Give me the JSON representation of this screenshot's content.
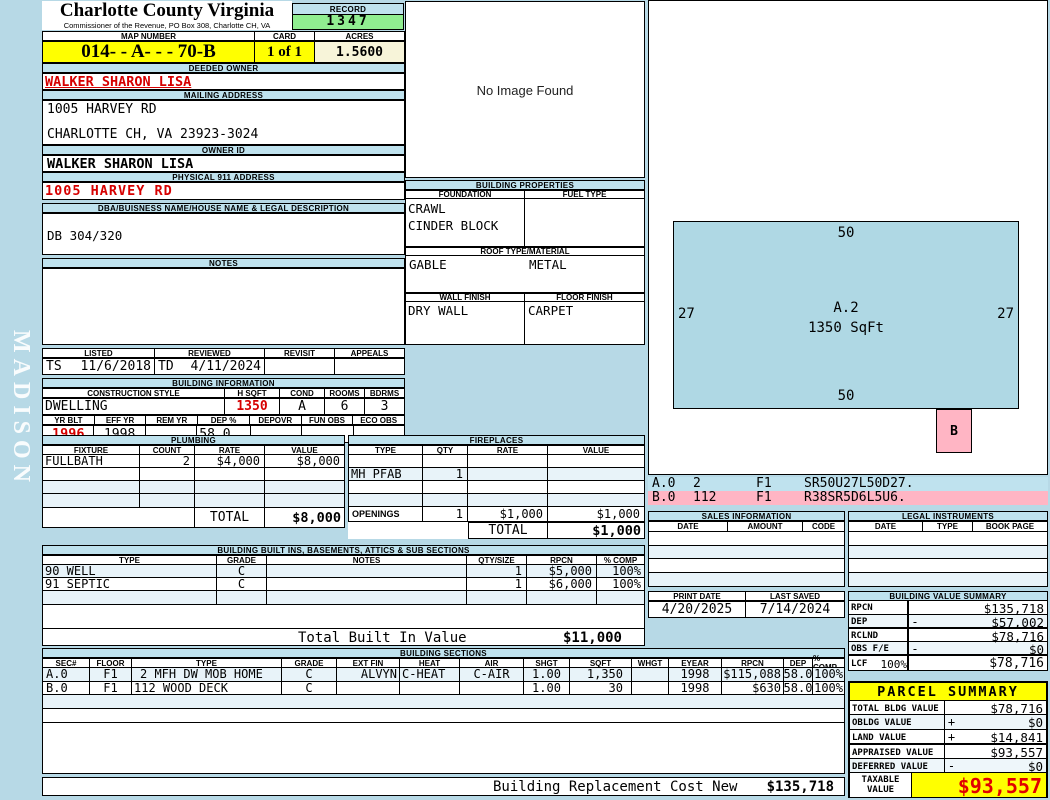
{
  "sidebar": {
    "watermark": "MADISON"
  },
  "colors": {
    "page_bg": "#b7d9e6",
    "header_blue": "#bfe2ee",
    "record_green": "#90ee90",
    "highlight_yellow": "#ffff00",
    "acres_cream": "#f7f4d9",
    "pink": "#ffb5c4",
    "sketch_blue": "#afd8e4",
    "alert_red": "#d60000"
  },
  "header": {
    "county": "Charlotte County Virginia",
    "commissioner": "Commissioner of the Revenue, PO Box 308, Charlotte CH, VA",
    "record_label": "RECORD",
    "record_value": "1347",
    "map_number_label": "MAP NUMBER",
    "map_number": "014- - A-  -  - 70-B",
    "card_label": "CARD",
    "card_value": "1 of 1",
    "acres_label": "ACRES",
    "acres_value": "1.5600"
  },
  "owner": {
    "deeded_owner_label": "DEEDED OWNER",
    "deeded_owner": "WALKER SHARON LISA",
    "mailing_address_label": "MAILING ADDRESS",
    "mailing_line1": "1005 HARVEY RD",
    "mailing_line2": "CHARLOTTE CH, VA 23923-3024",
    "owner_id_label": "OWNER ID",
    "owner_id": "WALKER SHARON LISA",
    "physical_label": "PHYSICAL 911 ADDRESS",
    "physical_address": "1005 HARVEY RD",
    "dba_label": "DBA/BUISNESS NAME/HOUSE NAME & LEGAL DESCRIPTION",
    "dba_value": "DB 304/320",
    "notes_label": "NOTES",
    "notes_value": ""
  },
  "photo": {
    "placeholder": "No Image Found"
  },
  "building_properties": {
    "title": "BUILDING PROPERTIES",
    "foundation_label": "FOUNDATION",
    "fuel_label": "FUEL TYPE",
    "foundation_line1": "CRAWL",
    "foundation_line2": "CINDER BLOCK",
    "fuel": "",
    "roof_label": "ROOF TYPE/MATERIAL",
    "roof_type": "GABLE",
    "roof_material": "METAL",
    "wall_label": "WALL FINISH",
    "floor_label": "FLOOR FINISH",
    "wall_finish": "DRY WALL",
    "floor_finish": "CARPET"
  },
  "visits": {
    "listed_label": "LISTED",
    "reviewed_label": "REVIEWED",
    "revisit_label": "REVISIT",
    "appeals_label": "APPEALS",
    "listed_by": "TS",
    "listed_date": "11/6/2018",
    "reviewed_by": "TD",
    "reviewed_date": "4/11/2024",
    "revisit": "",
    "appeals": ""
  },
  "building_information": {
    "title": "BUILDING INFORMATION",
    "style_label": "CONSTRUCTION STYLE",
    "hsqft_label": "H SQFT",
    "cond_label": "COND",
    "rooms_label": "ROOMS",
    "bdrms_label": "BDRMS",
    "style": "DWELLING",
    "hsqft": "1350",
    "cond": "A",
    "rooms": "6",
    "bdrms": "3",
    "yrblt_label": "YR BLT",
    "effyr_label": "EFF YR",
    "remyr_label": "REM YR",
    "dep_label": "DEP %",
    "depovr_label": "DEPOVR",
    "funobs_label": "FUN OBS",
    "ecoobs_label": "ECO OBS",
    "yr_blt": "1996",
    "eff_yr": "1998",
    "rem_yr": "",
    "dep_pct": "58.0",
    "depovr": "",
    "fun_obs": "",
    "eco_obs": ""
  },
  "plumbing": {
    "title": "PLUMBING",
    "columns": [
      "FIXTURE",
      "COUNT",
      "RATE",
      "VALUE"
    ],
    "rows": [
      [
        "FULLBATH",
        "2",
        "$4,000",
        "$8,000"
      ],
      [
        "",
        "",
        "",
        ""
      ],
      [
        "",
        "",
        "",
        ""
      ],
      [
        "",
        "",
        "",
        ""
      ]
    ],
    "total_label": "TOTAL",
    "total_value": "$8,000"
  },
  "fireplaces": {
    "title": "FIREPLACES",
    "columns": [
      "TYPE",
      "QTY",
      "RATE",
      "VALUE"
    ],
    "rows": [
      [
        "",
        "",
        "",
        ""
      ],
      [
        "MH PFAB",
        "1",
        "",
        ""
      ],
      [
        "",
        "",
        "",
        ""
      ],
      [
        "",
        "",
        "",
        ""
      ],
      [
        "OPENINGS",
        "1",
        "$1,000",
        "$1,000"
      ]
    ],
    "total_label": "TOTAL",
    "total_value": "$1,000"
  },
  "built_ins": {
    "title": "BUILDING BUILT INS, BASEMENTS, ATTICS & SUB SECTIONS",
    "columns": [
      "TYPE",
      "GRADE",
      "NOTES",
      "QTY/SIZE",
      "RPCN",
      "% COMP"
    ],
    "rows": [
      [
        "90 WELL",
        "C",
        "",
        "1",
        "$5,000",
        "100%"
      ],
      [
        "91 SEPTIC",
        "C",
        "",
        "1",
        "$6,000",
        "100%"
      ],
      [
        "",
        "",
        "",
        "",
        "",
        ""
      ]
    ],
    "total_label": "Total Built In Value",
    "total_value": "$11,000"
  },
  "building_sections": {
    "title": "BUILDING SECTIONS",
    "columns": [
      "SEC#",
      "FLOOR",
      "TYPE",
      "GRADE",
      "EXT FIN",
      "HEAT",
      "AIR",
      "SHGT",
      "SQFT",
      "WHGT",
      "EYEAR",
      "RPCN",
      "DEP",
      "% COMP"
    ],
    "rows": [
      [
        "A.0",
        "F1",
        "2 MFH DW MOB HOME",
        "C",
        "ALVYN",
        "C-HEAT",
        "C-AIR",
        "1.00",
        "1,350",
        "",
        "1998",
        "$115,088",
        "58.0",
        "100%"
      ],
      [
        "B.0",
        "F1",
        "112 WOOD DECK",
        "C",
        "",
        "",
        "",
        "1.00",
        "30",
        "",
        "1998",
        "$630",
        "58.0",
        "100%"
      ],
      [
        "",
        "",
        "",
        "",
        "",
        "",
        "",
        "",
        "",
        "",
        "",
        "",
        "",
        ""
      ],
      [
        "",
        "",
        "",
        "",
        "",
        "",
        "",
        "",
        "",
        "",
        "",
        "",
        "",
        ""
      ]
    ],
    "footer_label": "Building Replacement Cost New",
    "footer_value": "$135,718"
  },
  "sketch": {
    "area_label": "A.2",
    "area_sqft": "1350 SqFt",
    "dim_top": "50",
    "dim_bottom": "50",
    "dim_left": "27",
    "dim_right": "27",
    "b_label": "B",
    "segments": [
      {
        "sec": "A.0",
        "size": "2",
        "floor": "F1",
        "code": "SR50U27L50D27."
      },
      {
        "sec": "B.0",
        "size": "112",
        "floor": "F1",
        "code": "R38SR5D6L5U6."
      }
    ]
  },
  "sales": {
    "title": "SALES INFORMATION",
    "columns": [
      "DATE",
      "AMOUNT",
      "CODE"
    ]
  },
  "legal": {
    "title": "LEGAL INSTRUMENTS",
    "columns": [
      "DATE",
      "TYPE",
      "BOOK PAGE"
    ]
  },
  "dates": {
    "print_label": "PRINT DATE",
    "print_date": "4/20/2025",
    "saved_label": "LAST SAVED",
    "saved_date": "7/14/2024"
  },
  "value_summary": {
    "title": "BUILDING VALUE SUMMARY",
    "rows": [
      {
        "label": "RPCN",
        "pct": "",
        "op": "",
        "value": "$135,718"
      },
      {
        "label": "DEP",
        "pct": "",
        "op": "-",
        "value": "$57,002"
      },
      {
        "label": "RCLND",
        "pct": "",
        "op": "",
        "value": "$78,716"
      },
      {
        "label": "OBS F/E",
        "pct": "",
        "op": "-",
        "value": "$0"
      },
      {
        "label": "LCF",
        "pct": "100%",
        "op": "",
        "value": "$78,716"
      }
    ]
  },
  "parcel_summary": {
    "title": "PARCEL SUMMARY",
    "rows": [
      {
        "label": "TOTAL BLDG VALUE",
        "op": "",
        "value": "$78,716"
      },
      {
        "label": "OBLDG VALUE",
        "op": "+",
        "value": "$0"
      },
      {
        "label": "LAND VALUE",
        "op": "+",
        "value": "$14,841"
      },
      {
        "label": "APPRAISED VALUE",
        "op": "",
        "value": "$93,557"
      },
      {
        "label": "DEFERRED VALUE",
        "op": "-",
        "value": "$0"
      }
    ],
    "taxable_label_1": "TAXABLE",
    "taxable_label_2": "VALUE",
    "taxable_value": "$93,557"
  }
}
